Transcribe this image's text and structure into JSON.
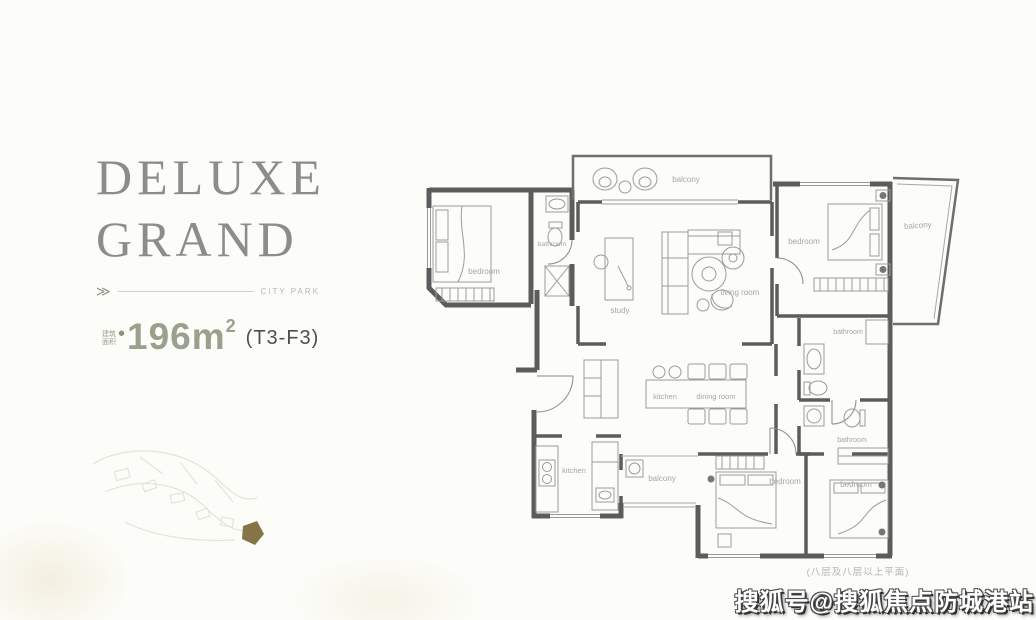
{
  "page": {
    "background": "#fcfcf8"
  },
  "panel": {
    "title_line1": "DELUXE",
    "title_line2": "GRAND",
    "title_color": "#8c8c8c",
    "chevron": "≫",
    "tagline": "CITY PARK",
    "area_label_line1": "建筑",
    "area_label_line2": "面积",
    "area_bullet": "•",
    "area_value": "196m",
    "area_sup": "2",
    "unit_code": "(T3-F3)",
    "accent_color": "#99a08b"
  },
  "floorplan": {
    "wall_color": "#5c5c5c",
    "furniture_color": "#9b9b9b",
    "label_color": "#a6a6a6",
    "labels": {
      "balcony_top": "balcony",
      "bedroom_top_left": "bedroom",
      "bathroom_top_left": "bathroom",
      "study": "study",
      "living_room": "living room",
      "bedroom_top_right": "bedroom",
      "balcony_right": "balcony",
      "bathroom_right_upper": "bathroom",
      "bathroom_right_lower": "bathroom",
      "kitchen_island": "kitchen",
      "dining_room": "dining room",
      "kitchen": "kitchen",
      "balcony_bottom": "balcony",
      "bedroom_bottom_left": "bedroom",
      "bedroom_bottom_right": "bedroom",
      "floor_note": "(八层及八层以上平面)"
    }
  },
  "watermark": {
    "text": "搜狐号@搜狐焦点防城港站"
  }
}
